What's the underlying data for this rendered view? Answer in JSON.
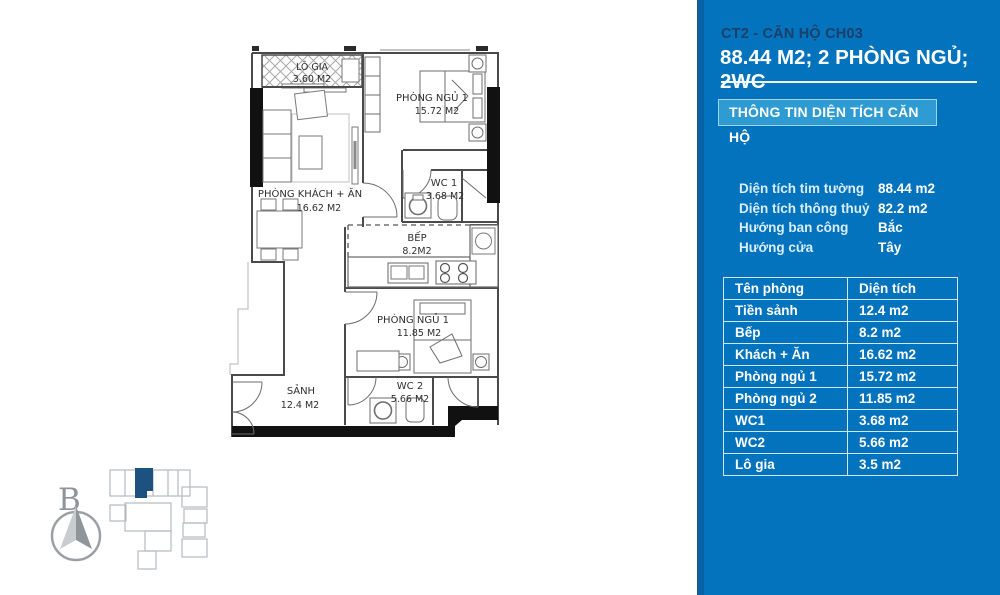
{
  "panel": {
    "title": "CT2 - CĂN HỘ CH03",
    "subtitle": "88.44 M2; 2 PHÒNG NGỦ; 2WC",
    "section_header": "THÔNG TIN DIỆN TÍCH CĂN HỘ",
    "details": [
      {
        "label": "Diện tích tim tường",
        "value": "88.44 m2"
      },
      {
        "label": "Diện tích thông thuỷ",
        "value": "82.2 m2"
      },
      {
        "label": "Hướng ban công",
        "value": "Bắc"
      },
      {
        "label": "Hướng cửa",
        "value": "Tây"
      }
    ],
    "table": {
      "headers": [
        "Tên phòng",
        "Diện tích"
      ],
      "rows": [
        [
          "Tiền sảnh",
          "12.4 m2"
        ],
        [
          "Bếp",
          "8.2 m2"
        ],
        [
          "Khách + Ăn",
          "16.62 m2"
        ],
        [
          "Phòng ngủ 1",
          "15.72 m2"
        ],
        [
          "Phòng ngủ 2",
          "11.85 m2"
        ],
        [
          "WC1",
          "3.68 m2"
        ],
        [
          "WC2",
          "5.66 m2"
        ],
        [
          "Lô gia",
          "3.5 m2"
        ]
      ]
    },
    "colors": {
      "panel_bg": "#0473bd",
      "panel_edge": "#0a60a2",
      "box_bg": "#2e9bd3",
      "title_color": "#1b4168"
    }
  },
  "floorplan": {
    "rooms": [
      {
        "name": "LÔ GIA",
        "area": "3.60 M2"
      },
      {
        "name": "PHÒNG NGỦ 1",
        "area": "15.72 M2"
      },
      {
        "name": "PHÒNG KHÁCH + ĂN",
        "area": "16.62 M2"
      },
      {
        "name": "WC 1",
        "area": "3.68 M2"
      },
      {
        "name": "BẾP",
        "area": "8.2M2"
      },
      {
        "name": "PHÒNG NGỦ 1",
        "area": "11.85 M2"
      },
      {
        "name": "SẢNH",
        "area": "12.4 M2"
      },
      {
        "name": "WC 2",
        "area": "5.66 M2"
      }
    ],
    "compass_label": "B",
    "keyplan_highlight_color": "#1d5180"
  }
}
